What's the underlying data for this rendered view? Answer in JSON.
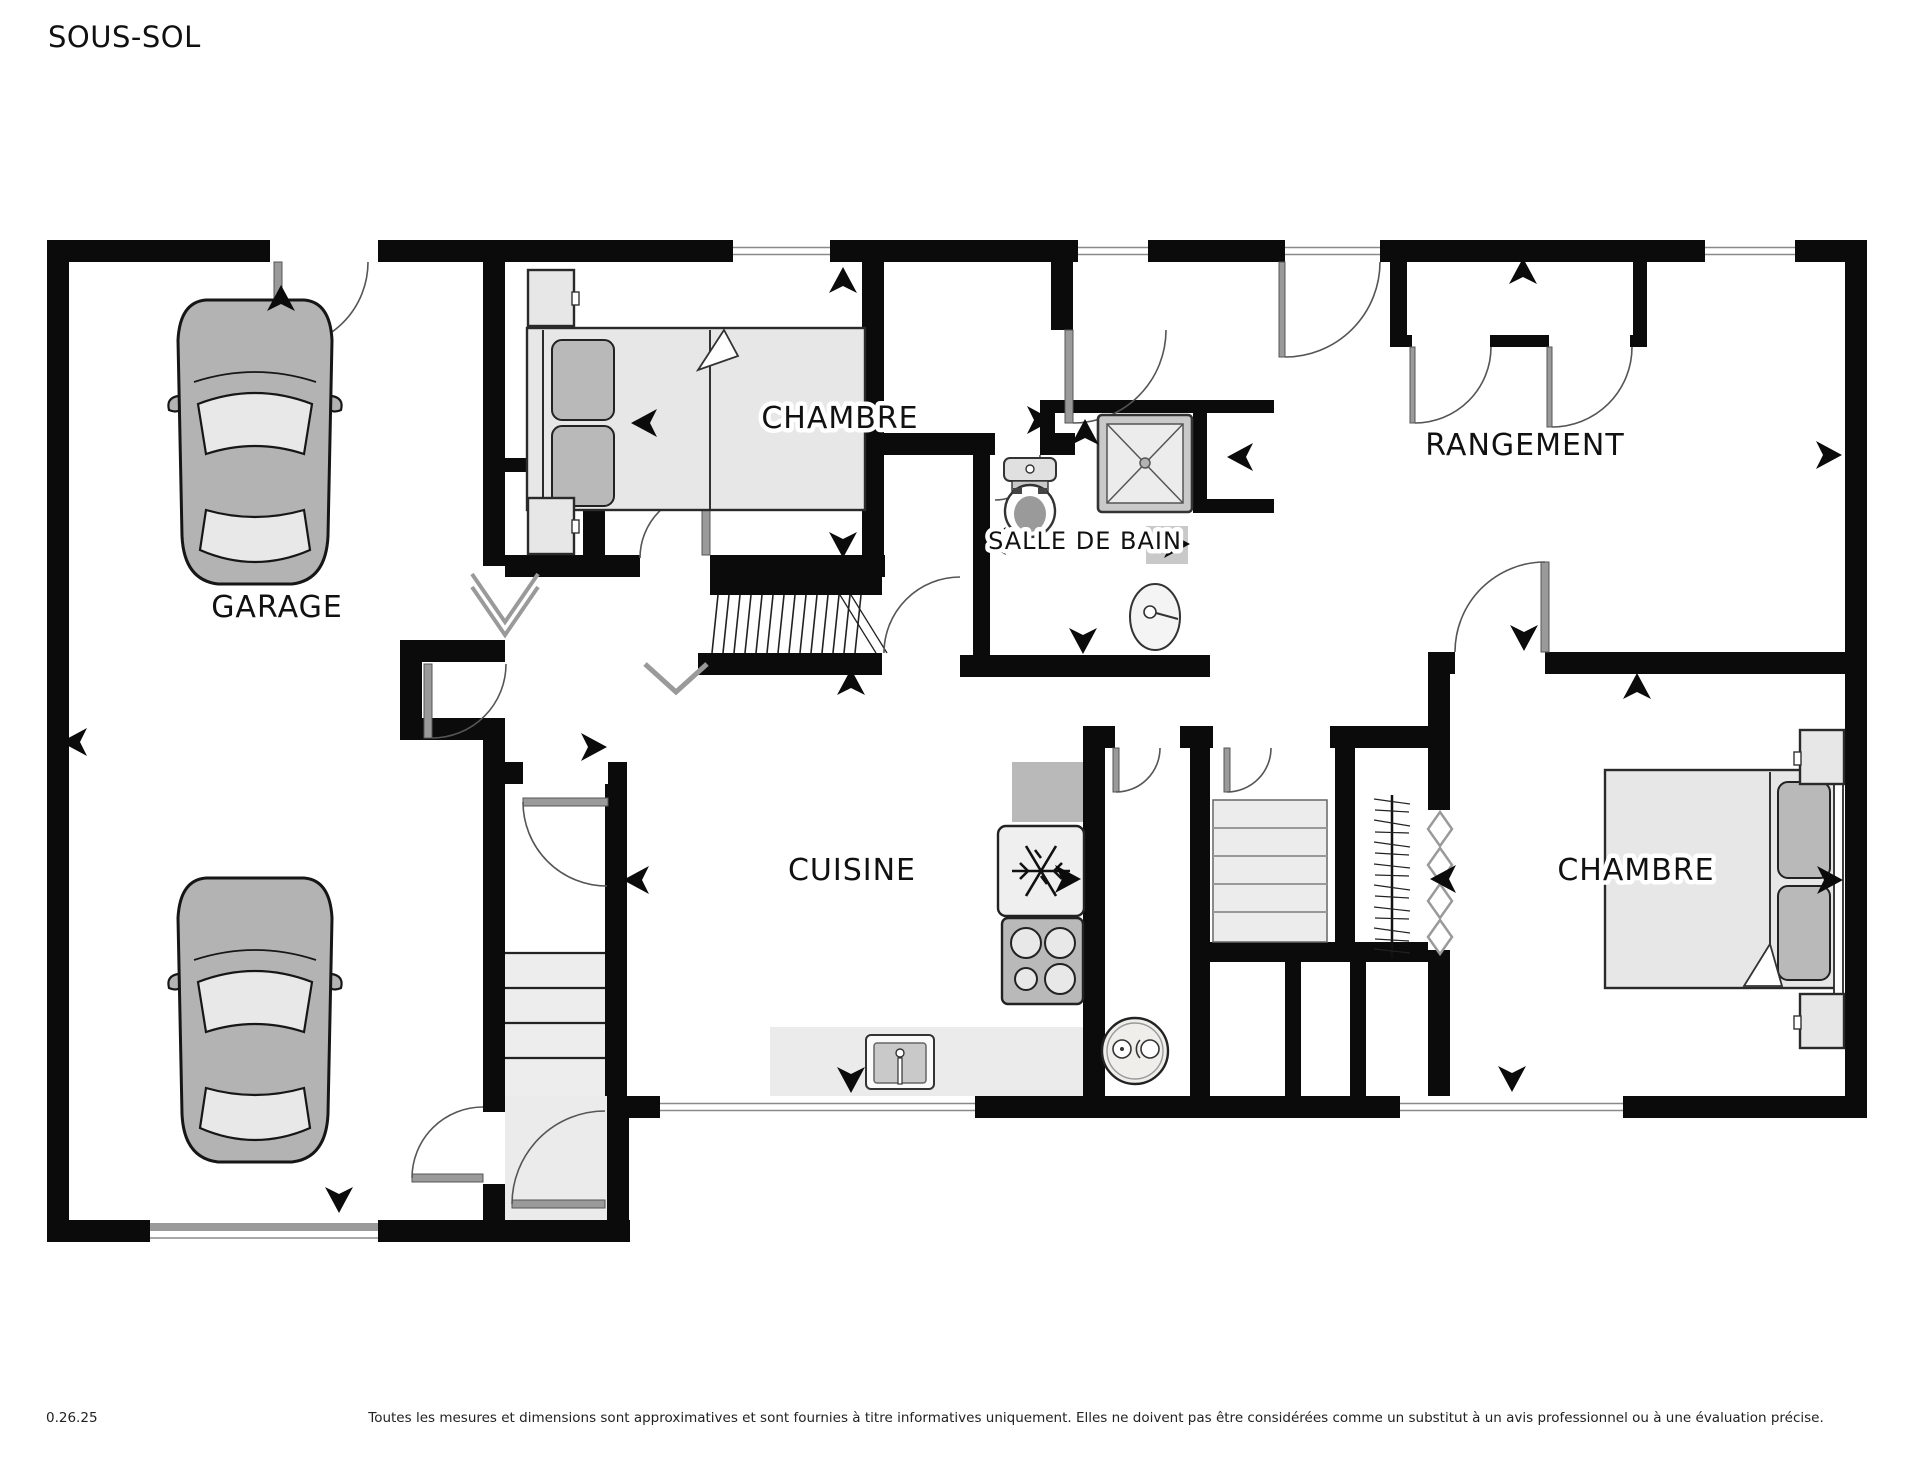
{
  "page": {
    "title": "SOUS-SOL"
  },
  "rooms": {
    "garage": "GARAGE",
    "bedroom_top": "CHAMBRE",
    "bathroom": "SALLE DE BAIN",
    "storage": "RANGEMENT",
    "kitchen": "CUISINE",
    "bedroom_right": "CHAMBRE"
  },
  "footer": {
    "version": "0.26.25",
    "disclaimer": "Toutes les mesures et dimensions sont approximatives et sont fournies à titre informatives uniquement. Elles ne doivent pas être considérées comme un substitut à un avis professionnel ou à une évaluation précise."
  },
  "icons": {
    "fridge": "snowflake-icon",
    "stove": "four-burners-icon",
    "shower": "shower-x-icon",
    "toilet": "toilet-icon",
    "bathroom_sink": "oval-sink-icon",
    "kitchen_sink": "kitchen-sink-icon",
    "water_heater": "water-heater-icon",
    "car": "car-top-view-icon",
    "direction_arrow": "direction-arrow-icon"
  }
}
